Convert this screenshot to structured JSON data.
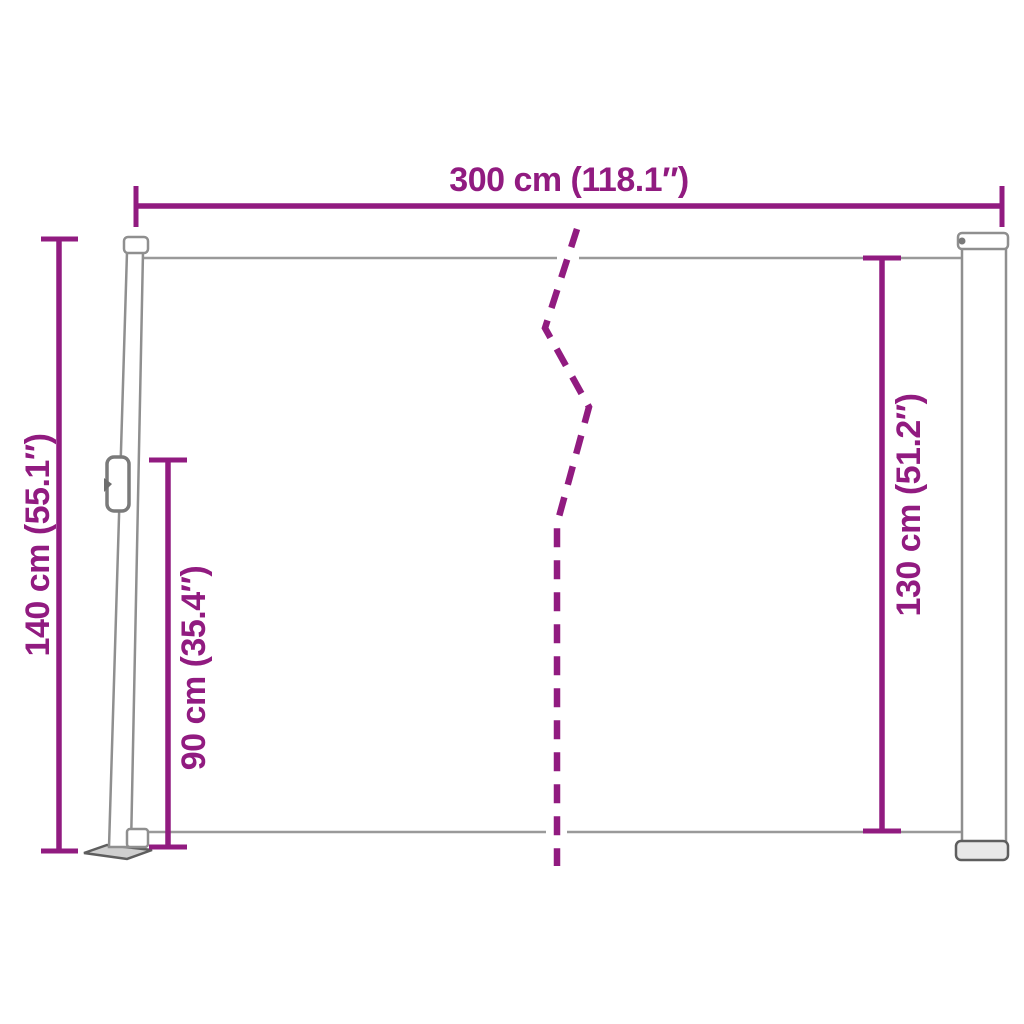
{
  "diagram": {
    "accent_color": "#911B80",
    "structure_color": "#8F8F8F",
    "structure_dark_color": "#5E5E5E",
    "background_color": "#FFFFFF",
    "labels": {
      "width_top": "300 cm (118.1″)",
      "height_left_total": "140 cm (55.1″)",
      "height_front_post": "90 cm (35.4″)",
      "height_right_cassette": "130 cm (51.2″)"
    }
  }
}
